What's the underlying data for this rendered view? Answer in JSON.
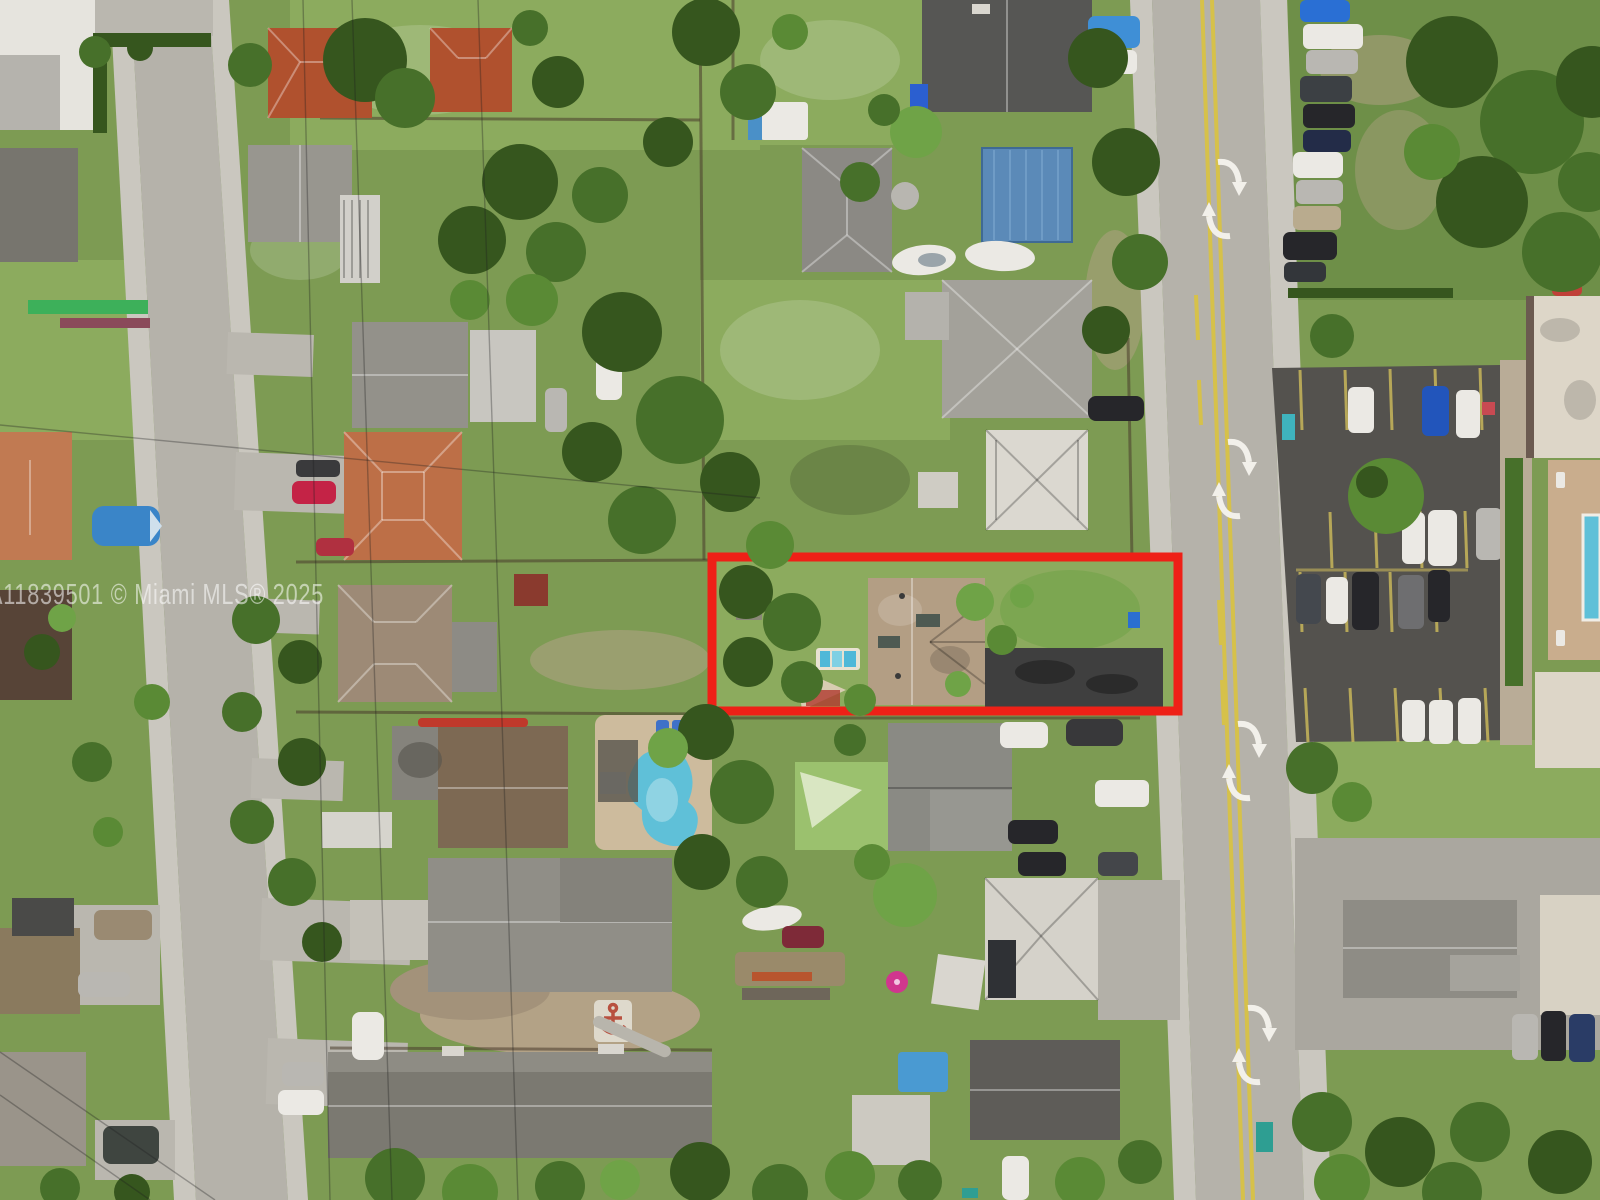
{
  "meta": {
    "title": "Aerial drone photo of residential neighborhood with subject property outlined",
    "type": "aerial-drone-photograph",
    "width_px": 1600,
    "height_px": 1200
  },
  "watermark": {
    "text": "A11839501 © Miami MLS® 2025",
    "color": "#ffffff",
    "opacity": 0.55
  },
  "highlight": {
    "purpose": "subject-property-outline",
    "color": "#ee2017",
    "x": 712,
    "y": 557,
    "width": 466,
    "height": 154,
    "stroke_px": 9
  },
  "scene": {
    "streets": {
      "left_street_surface": "#b5b2aa",
      "right_street_surface": "#b2afa7",
      "center_line_color": "#d6c14a",
      "turn_arrow_color": "#f2f0ea",
      "turn_arrow_pairs": 4
    },
    "palette": {
      "lawn": "#7d9b53",
      "tree_canopy": "#47702a",
      "dirt": "#b3a286",
      "parking_asphalt": "#54524e",
      "pool_water": "#5fc0d8",
      "red_tile_roof": "#b0512e",
      "gray_shingle_roof": "#908e87",
      "white_tile_roof": "#dbd8d0",
      "tan_paver_roof": "#b39e84",
      "blue_metal_roof": "#5b8ab8",
      "driveway_asphalt": "#3f3f3f"
    },
    "subject_property": {
      "roof": "tan-paver-hip-roof",
      "features": [
        "front lawn",
        "dark asphalt driveway",
        "small plunge pool",
        "shade sail",
        "palm trees"
      ]
    }
  }
}
